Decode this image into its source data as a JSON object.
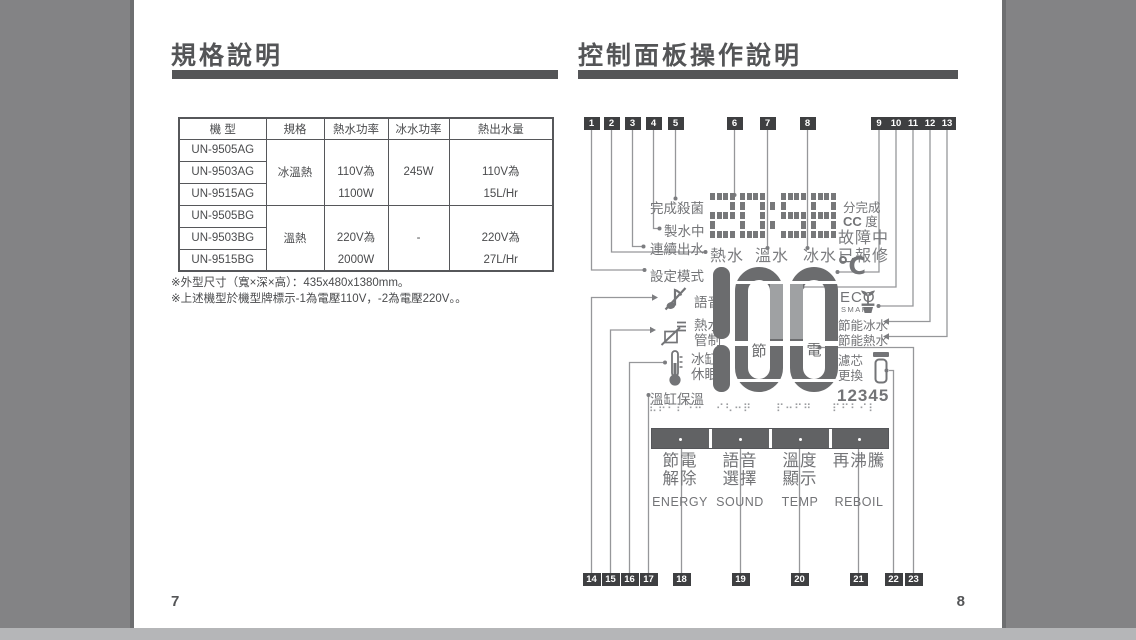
{
  "viewer": {
    "left_page_number": "7",
    "right_page_number": "8"
  },
  "left_page": {
    "title": "規格說明",
    "table": {
      "headers": [
        "機 型",
        "規格",
        "熱水功率",
        "冰水功率",
        "熱出水量"
      ],
      "groups": [
        {
          "models": [
            "UN-9505AG",
            "UN-9503AG",
            "UN-9515AG"
          ],
          "spec": "冰溫熱",
          "hot_power_1": "110V為",
          "hot_power_2": "1100W",
          "cold_power": "245W",
          "output_1": "110V為",
          "output_2": "15L/Hr"
        },
        {
          "models": [
            "UN-9505BG",
            "UN-9503BG",
            "UN-9515BG"
          ],
          "spec": "溫熱",
          "hot_power_1": "220V為",
          "hot_power_2": "2000W",
          "cold_power": "-",
          "output_1": "220V為",
          "output_2": "27L/Hr"
        }
      ]
    },
    "notes": [
      "※外型尺寸（寬×深×高）：435x480x1380mm。",
      "※上述機型於機型牌標示-1為電壓110V，-2為電壓220V。。"
    ]
  },
  "right_page": {
    "title": "控制面板操作說明",
    "callouts_top": [
      "1",
      "2",
      "3",
      "4",
      "5",
      "6",
      "7",
      "8",
      "9",
      "10",
      "11",
      "12",
      "13"
    ],
    "callouts_bottom": [
      "14",
      "15",
      "16",
      "17",
      "18",
      "19",
      "20",
      "21",
      "22",
      "23"
    ],
    "lcd": {
      "time": "20:58",
      "done_sterilize": "完成殺菌",
      "making_water": "製水中",
      "continuous_out": "連續出水",
      "set_mode": "設定模式",
      "voice": "語音",
      "hot_ctrl_1": "熱水",
      "hot_ctrl_2": "管制",
      "ice_sleep_1": "冰缸",
      "ice_sleep_2": "休眠",
      "warm_keep": "溫缸保溫",
      "hot": "熱水",
      "warm": "溫水",
      "cold": "冰水",
      "reported": "已報修",
      "min_done": "分完成",
      "cc": "CC",
      "deg": "度",
      "fault": "故障中",
      "celsius": "℃",
      "eco": "ECO",
      "smart": "SMART",
      "eco_cold": "節能冰水",
      "eco_hot": "節能熱水",
      "big_number": "100",
      "save": "節",
      "power": "電",
      "filter_1": "濾芯",
      "filter_2": "更換",
      "filter_digits": "12345"
    },
    "buttons": [
      {
        "zh1": "節電",
        "zh2": "解除",
        "en": "ENERGY",
        "braille": "⠧⠗⠃⠏⠙⠛"
      },
      {
        "zh1": "語音",
        "zh2": "選擇",
        "en": "SOUND",
        "braille": "⠊⠣⠒⠟"
      },
      {
        "zh1": "溫度",
        "zh2": "顯示",
        "en": "TEMP",
        "braille": "⠏⠒⠋⠛"
      },
      {
        "zh1": "再沸騰",
        "zh2": "",
        "en": "REBOIL",
        "braille": "⠏⠋⠃⠊⠇"
      }
    ]
  }
}
